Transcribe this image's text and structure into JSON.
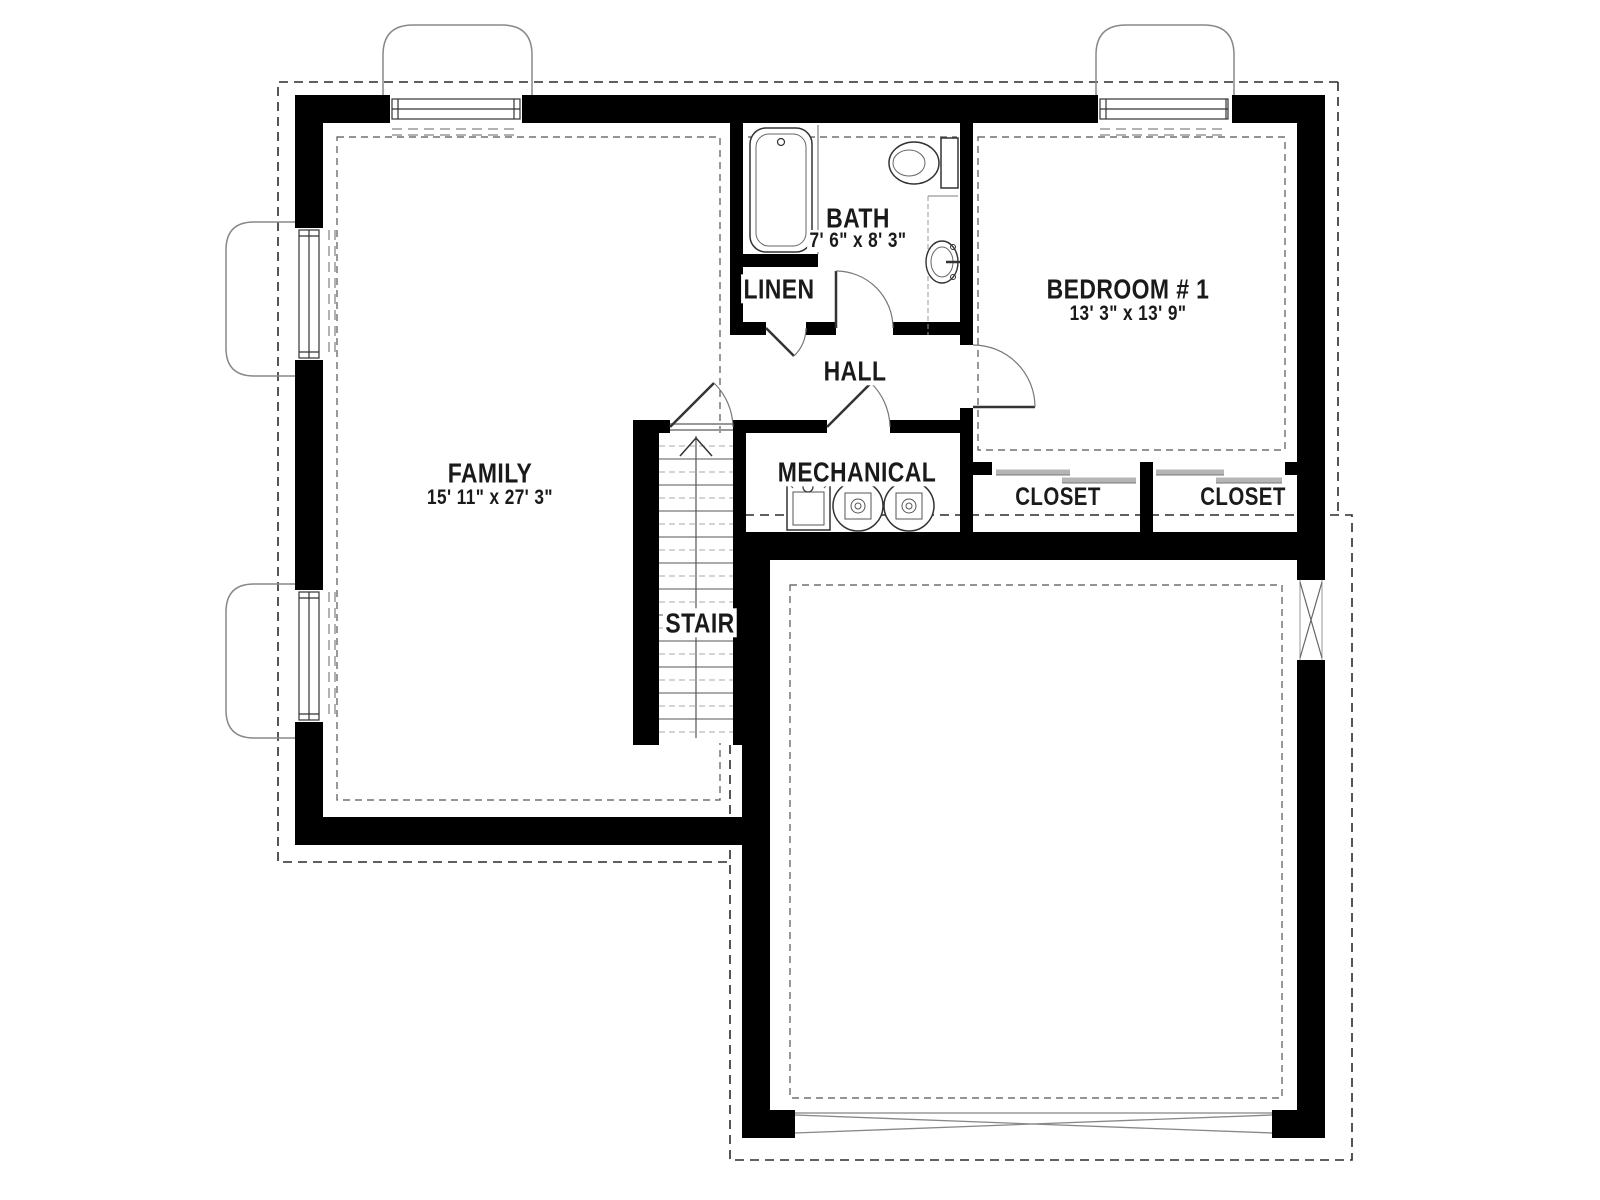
{
  "plan": {
    "rooms": {
      "family": {
        "name": "FAMILY",
        "dims": "15' 11\" x 27' 3\""
      },
      "bath": {
        "name": "BATH",
        "dims": "7' 6\" x 8' 3\""
      },
      "linen": {
        "name": "LINEN"
      },
      "hall": {
        "name": "HALL"
      },
      "bedroom1": {
        "name": "BEDROOM # 1",
        "dims": "13' 3\" x 13' 9\""
      },
      "mechanical": {
        "name": "MECHANICAL"
      },
      "stair": {
        "name": "STAIR"
      },
      "closet_left": {
        "name": "CLOSET"
      },
      "closet_right": {
        "name": "CLOSET"
      }
    },
    "colors": {
      "wall": "#000000",
      "background": "#ffffff",
      "thin_line": "#444444",
      "light_line": "#999999"
    }
  }
}
